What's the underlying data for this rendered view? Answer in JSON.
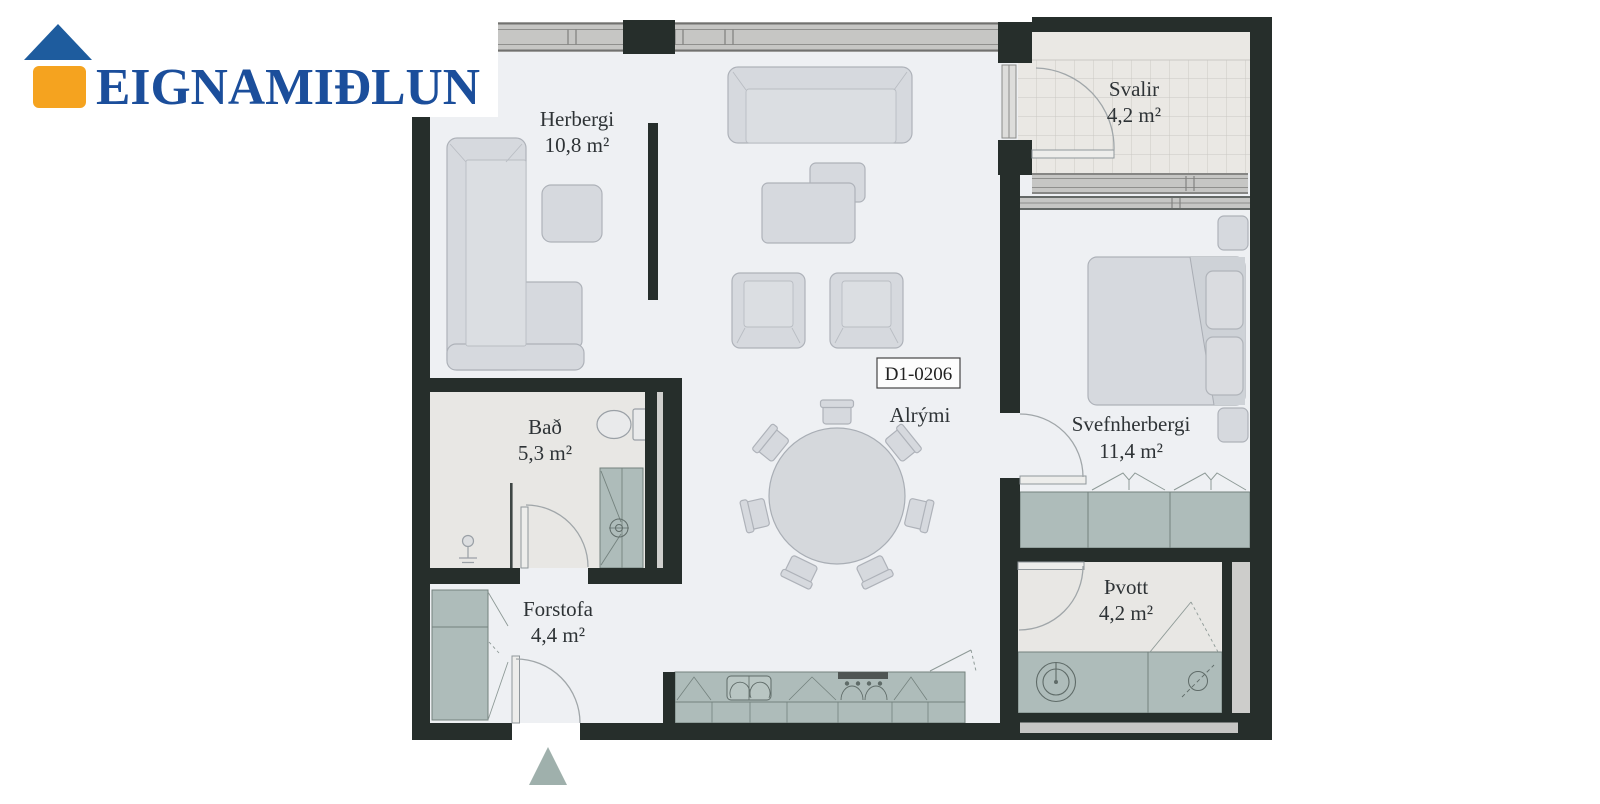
{
  "brand": {
    "name": "EIGNAMIÐLUN"
  },
  "floorplan": {
    "unit_id": "D1-0206",
    "rooms": {
      "herbergi": {
        "name": "Herbergi",
        "area": "10,8 m²"
      },
      "svalir": {
        "name": "Svalir",
        "area": "4,2 m²"
      },
      "bad": {
        "name": "Bað",
        "area": "5,3 m²"
      },
      "alrymi": {
        "name": "Alrými"
      },
      "svefnherbergi": {
        "name": "Svefnherbergi",
        "area": "11,4 m²"
      },
      "forstofa": {
        "name": "Forstofa",
        "area": "4,4 m²"
      },
      "thvott": {
        "name": "Þvott",
        "area": "4,2 m²"
      }
    },
    "colors": {
      "wall": "#262e2b",
      "floor": "#eef0f3",
      "wet_floor": "#e8e7e4",
      "window_gray": "#c6c6c4",
      "cabinet_sage": "#aebcba",
      "furniture_gray": "#d6d9de",
      "marker_sage": "#9fb0ac",
      "logo_blue": "#1b4e9b",
      "logo_roof_blue": "#1e5c9e",
      "logo_orange": "#f5a31f"
    }
  }
}
